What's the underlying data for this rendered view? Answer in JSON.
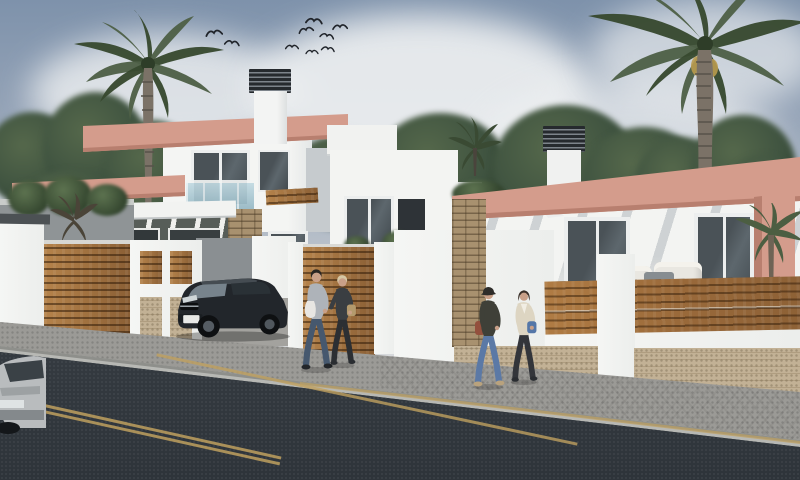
{
  "scene": {
    "description": "Photoreal 3D architectural render of a row of newly built modern white villas with salmon-pink parapets and pergolas, wood-slat and stone fencing, palm trees, a flock of birds, a dark SUV parked in a driveway, a partial silver car at street edge, and two couples walking right along the sidewalk beside a dark asphalt road with tan lane markings.",
    "style": "architectural exterior CGI",
    "time_of_day": "day"
  },
  "palette": {
    "sky_top": "#7e92ab",
    "sky_mid": "#aeb8c4",
    "cloud": "#eff1f2",
    "foliage_dark": "#24351f",
    "foliage_mid": "#3f5340",
    "foliage_light": "#55684b",
    "palm_frond": "#4e6047",
    "palm_frond_dark": "#37492f",
    "palm_trunk": "#7b7267",
    "palm_trunk_dark": "#57524a",
    "date_cluster": "#b99a4e",
    "wall_white": "#f3f4f2",
    "wall_shade": "#d9dcdd",
    "wall_dark_face": "#c6cbce",
    "accent_pink": "#d49c8c",
    "accent_pink_dark": "#b87f6f",
    "wood": "#a9743f",
    "wood_light": "#c08b52",
    "wood_gap": "#58391f",
    "stone_panel": "#c2b195",
    "stone_stack": "#a8916f",
    "hedge": "#243626",
    "glass_dark": "#3e464b",
    "glass_frame": "#eceeee",
    "balcony_glass": "#a9c8d4",
    "chimney_cap": "#262a2e",
    "chimney_stripe": "#7d848b",
    "road": "#3e454c",
    "road_dark": "#2e343a",
    "marking": "#bfa05f",
    "sidewalk": "#9b9a96",
    "curb": "#b7b8b4",
    "bird": "#20242a",
    "skin": "#c9a088"
  },
  "birds": {
    "count": 9,
    "flock": [
      [
        205,
        28,
        1,
        -8
      ],
      [
        223,
        38,
        0.9,
        6
      ],
      [
        283,
        42,
        0.8,
        0
      ],
      [
        297,
        25,
        0.9,
        -12
      ],
      [
        305,
        16,
        1,
        4
      ],
      [
        318,
        31,
        0.85,
        10
      ],
      [
        331,
        22,
        0.9,
        -4
      ],
      [
        319,
        44,
        0.8,
        8
      ],
      [
        303,
        47,
        0.75,
        0
      ]
    ]
  },
  "buildings": [
    {
      "id": "left-villa",
      "stories": 2,
      "features": [
        "salmon-pink roof band",
        "salmon-pink lower pergola frame",
        "white chimney with dark slatted cap",
        "balcony with light-blue glass balustrade",
        "covered terrace with white pergola slats",
        "stacked-stone column",
        "wood lintel beam"
      ]
    },
    {
      "id": "center-house",
      "stories": 2,
      "features": [
        "white roof box",
        "dark entry passage",
        "white entrance canopy with plants",
        "white planter"
      ]
    },
    {
      "id": "right-villa",
      "stories": 1,
      "features": [
        "salmon-pink parapet with pergola shadow stripes",
        "salmon-pink corner pillar",
        "white chimney with dark slatted cap",
        "two large sliding glass doors",
        "stacked-stone pillar",
        "cream outdoor sofas and table",
        "patio palm"
      ]
    }
  ],
  "fence": {
    "style": "white pillars with horizontal wood-slat infill and tan stone base panels",
    "left_modules": [
      "wood slat panel",
      "white frame with wood and stone insets",
      "driveway opening",
      "wood slat gate"
    ],
    "right_modules": [
      "long wood slat band",
      "white pillar",
      "stone base panels"
    ]
  },
  "vehicles": [
    {
      "id": "suv",
      "type": "dark SUV parked in driveway facing street",
      "body_color": "#22262b",
      "license_plate": ""
    },
    {
      "id": "car-partial",
      "type": "silver car, partially visible at bottom-left street edge",
      "body_color": "#b9bcbe"
    }
  ],
  "people": [
    {
      "id": "man1",
      "group": "couple-1",
      "description": "man in gray sweater and jeans carrying light jacket",
      "colors": {
        "top": "#aeb3b9",
        "bottom": "#46586e",
        "hair": "#2a2622",
        "bag": "#e8e6e2",
        "skin": "#c9a088",
        "shoe": "#23262a"
      }
    },
    {
      "id": "woman1",
      "group": "couple-1",
      "description": "blond woman in dark top with tan shoulder bag",
      "colors": {
        "top": "#3a3e42",
        "bottom": "#2c2f33",
        "hair": "#d6c7a4",
        "bag": "#b49a6d",
        "skin": "#c9a088",
        "shoe": "#2a2d31"
      }
    },
    {
      "id": "walker2",
      "group": "couple-2",
      "description": "walker in cap and dark jacket, blue jeans, red-brown bag",
      "colors": {
        "top": "#3f4038",
        "bottom": "#5b79a6",
        "hair": "#2e2d2a",
        "bag": "#93503d",
        "skin": "#c9a088",
        "shoe": "#b9a27d"
      }
    },
    {
      "id": "woman2",
      "group": "couple-2",
      "description": "dark-haired woman in cream cardigan with blue bag",
      "colors": {
        "top": "#ddd5c2",
        "bottom": "#33353a",
        "hair": "#3a2f28",
        "bag": "#5577a8",
        "skin": "#c9a088",
        "shoe": "#2a2d31"
      }
    }
  ],
  "road": {
    "surface": "dark asphalt",
    "markings": [
      "double tan edge line at bottom-left",
      "diagonal tan lane line",
      "tan line along right curb"
    ],
    "sidewalk": "light gray paving, patterned tiles on the right"
  },
  "landscape": {
    "large_palms": 2,
    "small_palms": 2,
    "hedges": 1,
    "background_tree_groups": 3
  }
}
